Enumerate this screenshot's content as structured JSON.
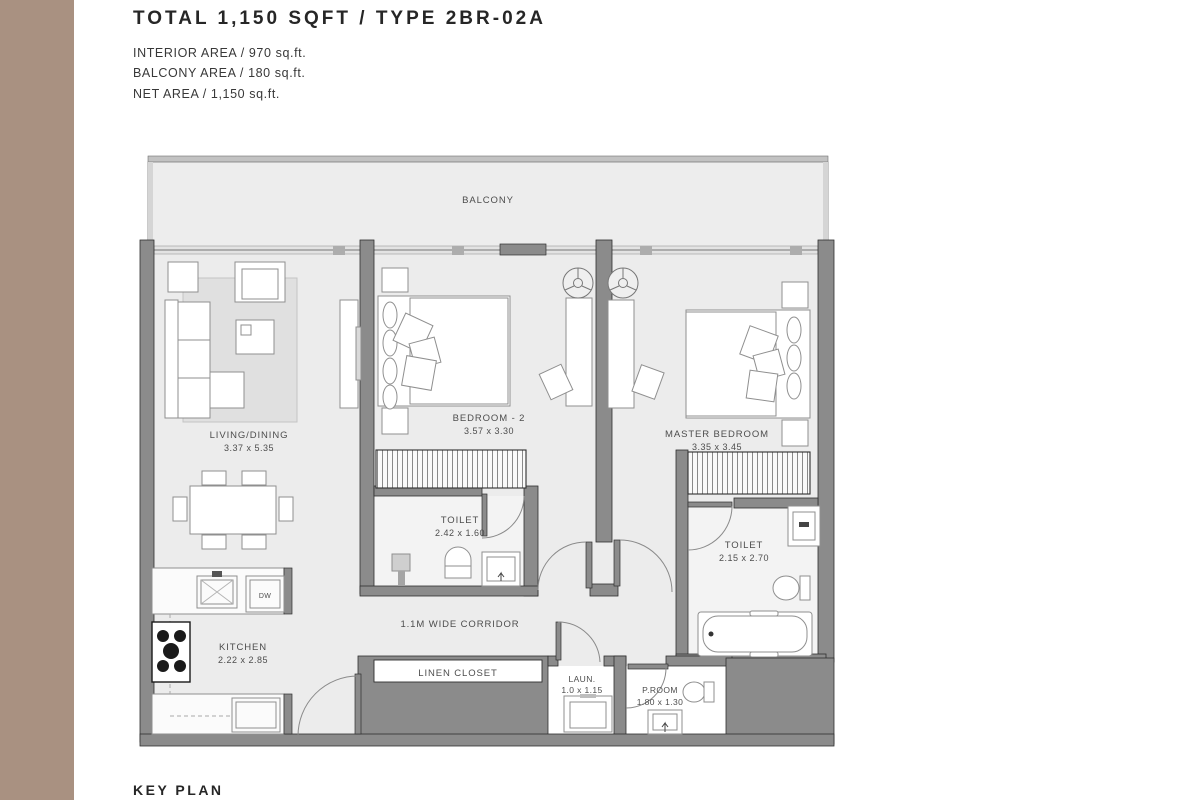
{
  "header": {
    "title": "TOTAL 1,150 SQFT / TYPE 2BR-02A",
    "interior_area": "INTERIOR AREA / 970 sq.ft.",
    "balcony_area": "BALCONY AREA / 180 sq.ft.",
    "net_area": "NET AREA / 1,150 sq.ft."
  },
  "footer": {
    "key_plan": "KEY PLAN"
  },
  "colors": {
    "accent_band": "#a99181",
    "wall": "#8b8b8b",
    "floor": "#ececec",
    "label_text": "#4d4d4d"
  },
  "plan": {
    "balcony": {
      "label": "BALCONY"
    },
    "living": {
      "label": "LIVING/DINING",
      "dims": "3.37 x 5.35"
    },
    "bedroom2": {
      "label": "BEDROOM - 2",
      "dims": "3.57 x 3.30"
    },
    "master": {
      "label": "MASTER BEDROOM",
      "dims": "3.35 x 3.45"
    },
    "toilet1": {
      "label": "TOILET",
      "dims": "2.42 x 1.60"
    },
    "toilet2": {
      "label": "TOILET",
      "dims": "2.15 x 2.70"
    },
    "kitchen": {
      "label": "KITCHEN",
      "dims": "2.22 x 2.85"
    },
    "corridor": {
      "label": "1.1M WIDE CORRIDOR"
    },
    "linen": {
      "label": "LINEN CLOSET"
    },
    "laundry": {
      "label": "LAUN.",
      "dims": "1.0 x 1.15"
    },
    "proom": {
      "label": "P.ROOM",
      "dims": "1.80 x 1.30"
    },
    "dishwasher": {
      "label": "DW"
    }
  }
}
